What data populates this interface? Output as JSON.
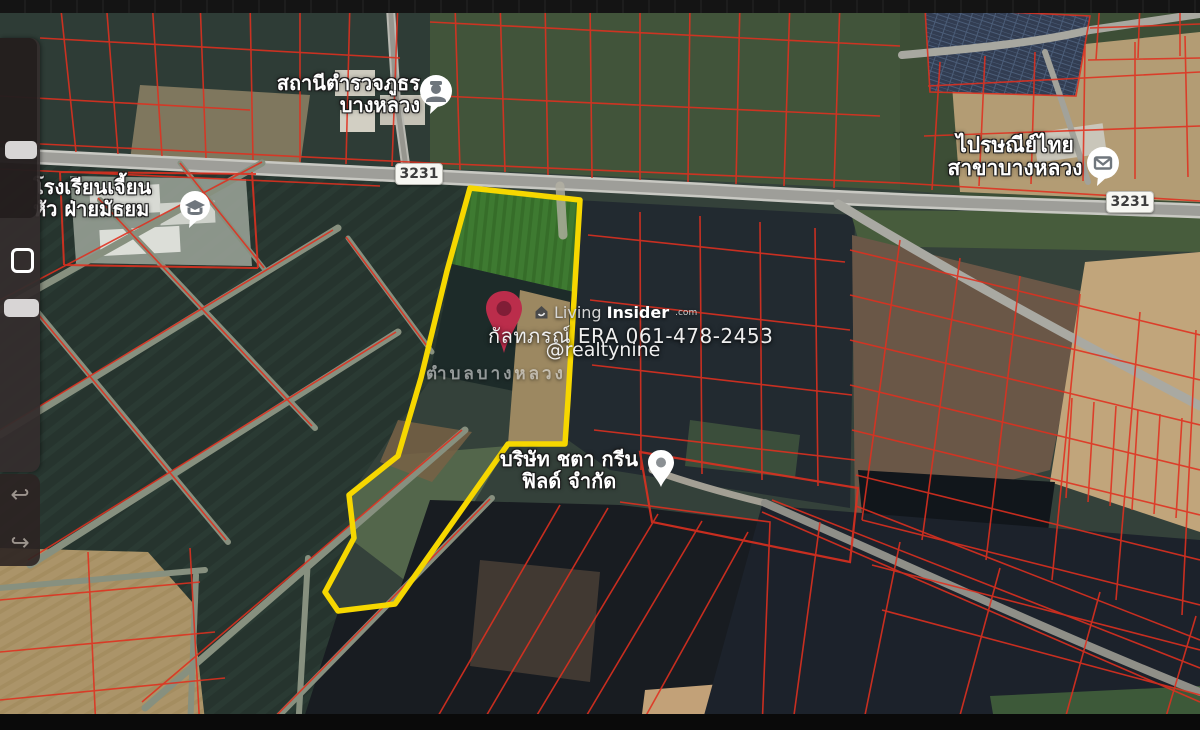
{
  "map": {
    "road_shields": [
      {
        "label": "3231"
      },
      {
        "label": "3231"
      }
    ],
    "pois": [
      {
        "name": "police-station",
        "icon": "police-officer-icon",
        "label_lines": [
          "สถานีตำรวจภูธร",
          "บางหลวง"
        ]
      },
      {
        "name": "school",
        "icon": "graduation-cap-icon",
        "label_lines": [
          "โรงเรียนเจี้ยน",
          "หัว ฝ่ายมัธยม"
        ]
      },
      {
        "name": "post-office",
        "icon": "envelope-icon",
        "label_lines": [
          "ไปรษณีย์ไทย",
          "สาขาบางหลวง"
        ]
      },
      {
        "name": "company",
        "icon": "place-pin-icon",
        "label_lines": [
          "บริษัท ชตา กรีน",
          "ฟิลด์ จำกัด"
        ]
      }
    ],
    "area_label": "ตำบลบางหลวง",
    "colors": {
      "boundary_yellow": "#f6d700",
      "parcel_red": "#e0301f",
      "road_gray": "#a5a5a0"
    }
  },
  "watermark": {
    "brand_light": "Living",
    "brand_bold": "Insider",
    "brand_suffix": ".com",
    "contact": "กัลทภรณ์ ERA 061-478-2453",
    "handle": "@realtynine",
    "pin_color": "#bb2d4b"
  },
  "toolbar": {
    "undo_glyph": "↩",
    "redo_glyph": "↪"
  }
}
